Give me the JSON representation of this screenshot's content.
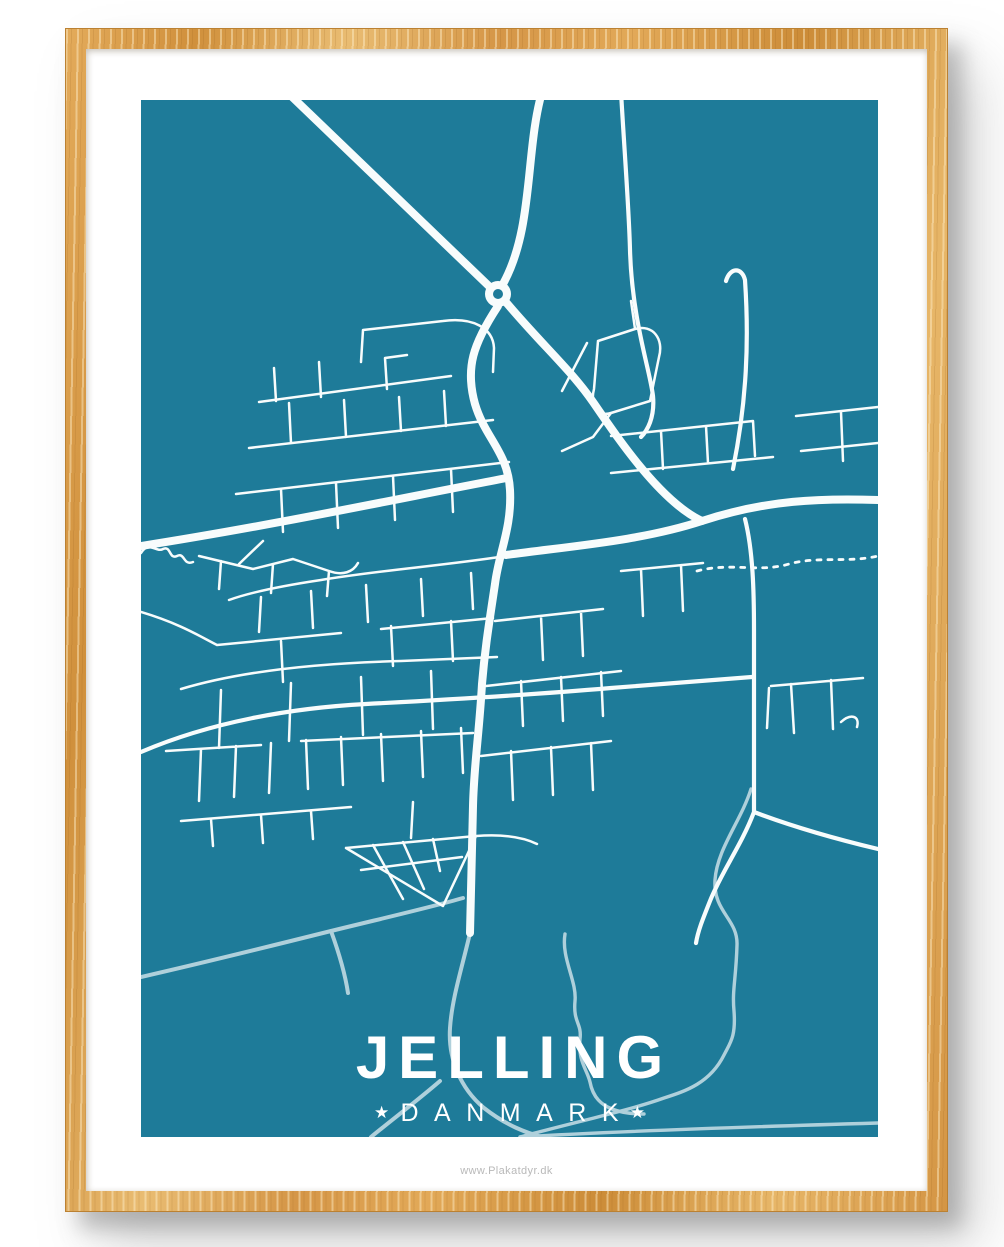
{
  "poster": {
    "title": "JELLING",
    "subtitle": "DANMARK",
    "star": "★",
    "watermark": "www.Plakatdyr.dk"
  },
  "map": {
    "type": "street-map-poster",
    "place_label": "JELLING",
    "country_label": "DANMARK",
    "features": [
      "roads",
      "roundabout",
      "streams",
      "ponds",
      "dashed-trail"
    ]
  },
  "colors": {
    "poster_background": "#1E7B99",
    "road": "#F8FCFC",
    "water": "#AFD0DB",
    "pond": "#CBC8C2",
    "mat": "#FFFFFF",
    "frame_wood": "#D89B46",
    "watermark_text": "#B9B9B9",
    "title_text": "#FFFFFF"
  }
}
